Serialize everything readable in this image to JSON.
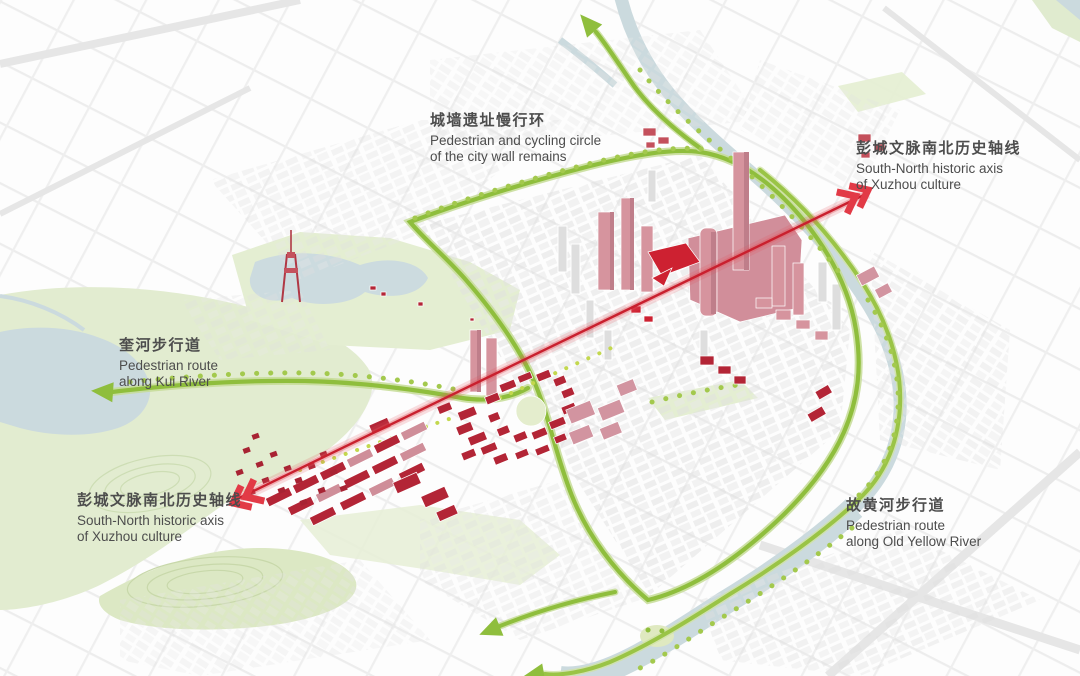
{
  "annotations": {
    "city_wall_circle": {
      "zh": "城墙遗址慢行环",
      "en_line1": "Pedestrian and cycling circle",
      "en_line2": "of the city wall remains"
    },
    "axis_north_end": {
      "zh": "彭城文脉南北历史轴线",
      "en_line1": "South-North historic axis",
      "en_line2": "of Xuzhou culture"
    },
    "kui_river": {
      "zh": "奎河步行道",
      "en_line1": "Pedestrian route",
      "en_line2": "along Kui River"
    },
    "axis_south_end": {
      "zh": "彭城文脉南北历史轴线",
      "en_line1": "South-North historic axis",
      "en_line2": "of Xuzhou culture"
    },
    "old_yellow_river": {
      "zh": "故黄河步行道",
      "en_line1": "Pedestrian route",
      "en_line2": "along Old Yellow River"
    }
  },
  "palette": {
    "route_green": "#8fbe3d",
    "tree_green": "#a3c94d",
    "park_green": "#e4eed2",
    "water_blue": "#cbdade",
    "axis_red": "#c9202e",
    "arrow_red": "#e23a46",
    "heritage_dark_red": "#b32536",
    "heritage_pink": "#d6949e",
    "city_gray": "#e6e6e6",
    "label_text": "#4d4d4d"
  }
}
